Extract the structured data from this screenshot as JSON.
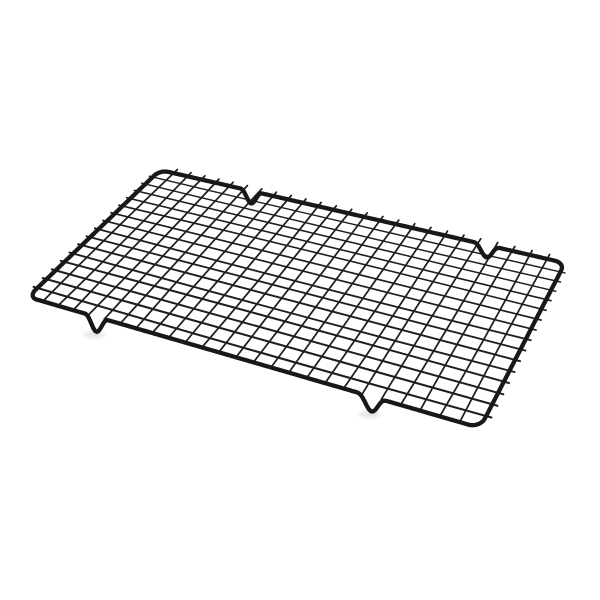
{
  "scene": {
    "type": "product-photo",
    "subject": "Black nonstick metal wire cooling rack for baking, shown at an angle on a plain white background",
    "background_color": "#ffffff"
  },
  "rack": {
    "frame_color": "#181818",
    "wire_color": "#1e1e1e",
    "frame_stroke_width": 4.3,
    "wire_stroke_width_far": 1.35,
    "wire_stroke_width_near": 2.15,
    "vertical_wire_stroke_width": 1.75,
    "columns": 26,
    "rows": 16,
    "corners": {
      "top_left": [
        160,
        170
      ],
      "top_right": [
        565,
        263
      ],
      "bottom_right": [
        480,
        428
      ],
      "bottom_left": [
        28,
        297
      ]
    },
    "corner_radius_u": 0.022,
    "corner_radius_v": 0.05,
    "feet": {
      "top_edge_positions": [
        0.25,
        0.827
      ],
      "bottom_edge_positions": [
        0.173,
        0.788
      ],
      "half_width": 0.03,
      "top_depth": 12.5,
      "bottom_depth": 15
    },
    "top_nub_length": 0.032,
    "side_nub_length": 0.01,
    "shadow_color": "rgba(0,0,0,0.10)",
    "shadow_color_faint": "rgba(0,0,0,0.06)"
  }
}
